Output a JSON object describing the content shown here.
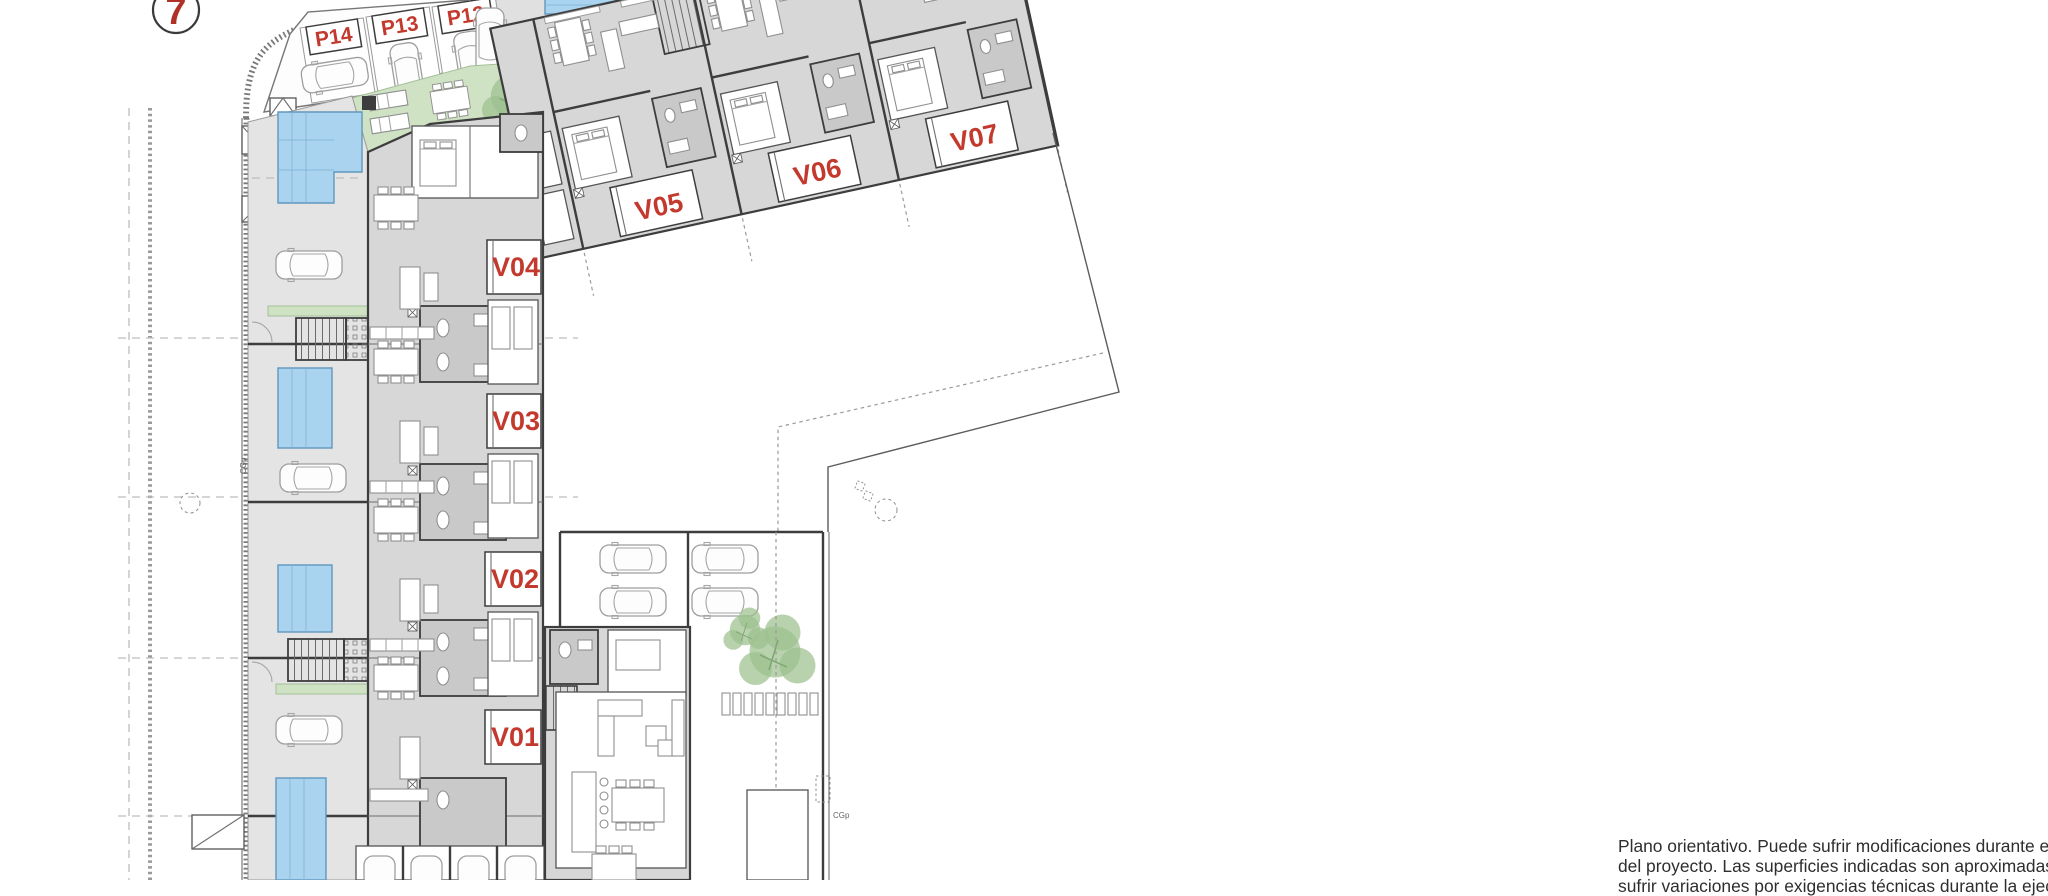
{
  "marker": {
    "number": "7"
  },
  "parking": {
    "spots": [
      {
        "label": "P14"
      },
      {
        "label": "P13"
      },
      {
        "label": "P12"
      }
    ]
  },
  "units": {
    "row": [
      {
        "label": "V05"
      },
      {
        "label": "V06"
      },
      {
        "label": "V07"
      }
    ],
    "column": [
      {
        "label": "V04"
      },
      {
        "label": "V03"
      },
      {
        "label": "V02"
      },
      {
        "label": "V01"
      }
    ]
  },
  "annotations": {
    "utility_box": "CGp"
  },
  "disclaimer": {
    "lines": [
      "Plano orientativo. Puede sufrir modificaciones durante el desarrollo",
      "del proyecto. Las superficies indicadas son aproximadas y podrán",
      "sufrir variaciones por exigencias técnicas durante la ejecución de la obra"
    ]
  },
  "colors": {
    "accent_red": "#c4392d",
    "pool_blue": "#a9d3ee",
    "green": "#cfe2c4",
    "floor_gray": "#d7d7d7",
    "wall_dark": "#3d3d3d"
  }
}
